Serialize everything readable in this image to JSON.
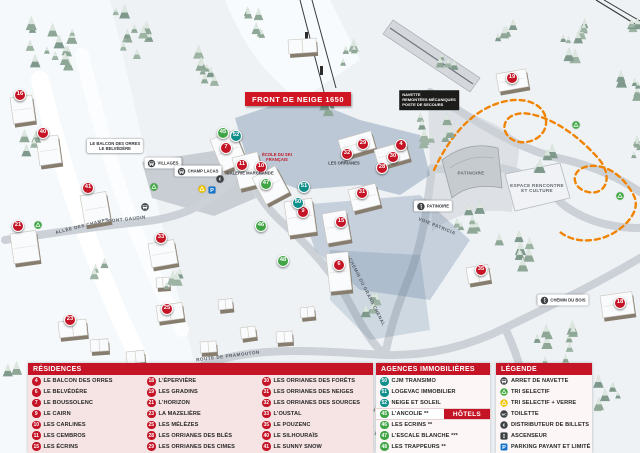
{
  "map": {
    "banner": "FRONT DE NEIGE 1650",
    "markers": [
      {
        "n": "16",
        "type": "residence",
        "x": 20,
        "y": 95
      },
      {
        "n": "40",
        "type": "residence",
        "x": 43,
        "y": 133
      },
      {
        "n": "41",
        "type": "residence",
        "x": 88,
        "y": 188
      },
      {
        "n": "21",
        "type": "residence",
        "x": 18,
        "y": 226
      },
      {
        "n": "23",
        "type": "residence",
        "x": 70,
        "y": 320
      },
      {
        "n": "25",
        "type": "residence",
        "x": 167,
        "y": 309
      },
      {
        "n": "33",
        "type": "residence",
        "x": 161,
        "y": 238
      },
      {
        "n": "7",
        "type": "residence",
        "x": 226,
        "y": 148
      },
      {
        "n": "11",
        "type": "residence",
        "x": 242,
        "y": 165
      },
      {
        "n": "10",
        "type": "residence",
        "x": 261,
        "y": 167
      },
      {
        "n": "9",
        "type": "residence",
        "x": 303,
        "y": 212
      },
      {
        "n": "15",
        "type": "residence",
        "x": 341,
        "y": 222
      },
      {
        "n": "6",
        "type": "residence",
        "x": 339,
        "y": 265
      },
      {
        "n": "29",
        "type": "residence",
        "x": 363,
        "y": 144
      },
      {
        "n": "32",
        "type": "residence",
        "x": 347,
        "y": 154
      },
      {
        "n": "4",
        "type": "residence",
        "x": 401,
        "y": 145
      },
      {
        "n": "30",
        "type": "residence",
        "x": 393,
        "y": 157
      },
      {
        "n": "28",
        "type": "residence",
        "x": 382,
        "y": 168
      },
      {
        "n": "31",
        "type": "residence",
        "x": 362,
        "y": 193
      },
      {
        "n": "19",
        "type": "residence",
        "x": 512,
        "y": 78
      },
      {
        "n": "35",
        "type": "residence",
        "x": 481,
        "y": 270
      },
      {
        "n": "18",
        "type": "residence",
        "x": 620,
        "y": 303
      },
      {
        "n": "52",
        "type": "agence",
        "x": 236,
        "y": 136
      },
      {
        "n": "51",
        "type": "agence",
        "x": 304,
        "y": 187
      },
      {
        "n": "50",
        "type": "agence",
        "x": 298,
        "y": 203
      },
      {
        "n": "45",
        "type": "hotel",
        "x": 223,
        "y": 133
      },
      {
        "n": "47",
        "type": "hotel",
        "x": 266,
        "y": 184
      },
      {
        "n": "46",
        "type": "hotel",
        "x": 261,
        "y": 226
      },
      {
        "n": "48",
        "type": "hotel",
        "x": 283,
        "y": 261
      }
    ],
    "labels": [
      {
        "cls": "darkbox",
        "lines": [
          "NAVETTE",
          "REMONTÉES MÉCANIQUES",
          "POSTE DE SECOURS"
        ],
        "x": 429,
        "y": 100
      },
      {
        "cls": "bldtext",
        "lines": [
          "PATINOIRE"
        ],
        "x": 471,
        "y": 173
      },
      {
        "cls": "bldtext",
        "lines": [
          "ESPACE RENCONTRE",
          "ET CULTURE"
        ],
        "x": 537,
        "y": 188
      },
      {
        "cls": "roadlbl",
        "lines": [
          "ALLÉE DES CHAMPS"
        ],
        "x": 82,
        "y": 226,
        "rot": -14
      },
      {
        "cls": "roadlbl",
        "lines": [
          "PONT GAUDIN"
        ],
        "x": 127,
        "y": 219,
        "rot": -6
      },
      {
        "cls": "roadlbl",
        "lines": [
          "ROUTE DE PRAMOUTON"
        ],
        "x": 228,
        "y": 356,
        "rot": -7
      },
      {
        "cls": "roadlbl",
        "lines": [
          "CHEMIN DU GRAND CHENAL"
        ],
        "x": 367,
        "y": 292,
        "rot": 63
      },
      {
        "cls": "roadlbl",
        "lines": [
          "VOIE PATRICIA"
        ],
        "x": 437,
        "y": 226,
        "rot": 22
      },
      {
        "cls": "tinylbl",
        "lines": [
          "GALERIE MARCHANDE"
        ],
        "x": 250,
        "y": 173
      },
      {
        "cls": "tinyred",
        "lines": [
          "ÉCOLE DU SKI",
          "FRANÇAIS"
        ],
        "x": 277,
        "y": 157
      },
      {
        "cls": "tinylbl",
        "lines": [
          "LES ORRIANES"
        ],
        "x": 344,
        "y": 163
      },
      {
        "cls": "pill",
        "lines": [
          "LE BALCON DES ORRES",
          "LE BELVÉDÈRE"
        ],
        "x": 115,
        "y": 146
      },
      {
        "cls": "pill-ic",
        "icon": "bus",
        "lines": [
          "VILLAGES"
        ],
        "x": 163,
        "y": 163
      },
      {
        "cls": "pill-ic",
        "icon": "bus",
        "lines": [
          "CHAMP LACAS"
        ],
        "x": 198,
        "y": 171
      },
      {
        "cls": "pill-ic",
        "icon": "skater",
        "lines": [
          "PATINOIRE"
        ],
        "x": 433,
        "y": 206
      },
      {
        "cls": "pill-ic",
        "icon": "walk",
        "lines": [
          "CHEMIN DU BOIS"
        ],
        "x": 563,
        "y": 300
      }
    ],
    "icons": [
      {
        "type": "bus",
        "x": 145,
        "y": 207
      },
      {
        "type": "recycle-green",
        "x": 38,
        "y": 225
      },
      {
        "type": "recycle-green",
        "x": 154,
        "y": 187
      },
      {
        "type": "recycle-green",
        "x": 576,
        "y": 125
      },
      {
        "type": "recycle-green",
        "x": 620,
        "y": 196
      },
      {
        "type": "recycle-yellow",
        "x": 202,
        "y": 189
      },
      {
        "type": "parking",
        "x": 212,
        "y": 190
      },
      {
        "type": "euro",
        "x": 220,
        "y": 179
      }
    ]
  },
  "legend": {
    "residences": {
      "title": "RÉSIDENCES",
      "items": [
        {
          "n": "4",
          "name": "LE BALCON DES ORRES"
        },
        {
          "n": "6",
          "name": "LE BELVÉDÈRE"
        },
        {
          "n": "7",
          "name": "LE BOUSSOLENC"
        },
        {
          "n": "9",
          "name": "LE CAIRN"
        },
        {
          "n": "10",
          "name": "LES CARLINES"
        },
        {
          "n": "11",
          "name": "LES CEMBROS"
        },
        {
          "n": "15",
          "name": "LES ÉCRINS"
        },
        {
          "n": "18",
          "name": "L'ÉPERVIÈRE"
        },
        {
          "n": "19",
          "name": "LES GRADINS"
        },
        {
          "n": "21",
          "name": "L'HORIZON"
        },
        {
          "n": "23",
          "name": "LA MAZELIÈRE"
        },
        {
          "n": "25",
          "name": "LES MÉLÈZES"
        },
        {
          "n": "28",
          "name": "LES ORRIANES DES BLÉS"
        },
        {
          "n": "29",
          "name": "LES ORRIANES DES CIMES"
        },
        {
          "n": "30",
          "name": "LES ORRIANES DES FORÊTS"
        },
        {
          "n": "31",
          "name": "LES ORRIANES DES NEIGES"
        },
        {
          "n": "32",
          "name": "LES ORRIANES DES SOURCES"
        },
        {
          "n": "33",
          "name": "L'OUSTAL"
        },
        {
          "n": "35",
          "name": "LE POUZENC"
        },
        {
          "n": "40",
          "name": "LE SILHOURAÏS"
        },
        {
          "n": "41",
          "name": "LE SUNNY SNOW"
        }
      ]
    },
    "agences": {
      "title": "AGENCES IMMOBILIÈRES",
      "items": [
        {
          "n": "50",
          "name": "CJM TRANSIMO"
        },
        {
          "n": "51",
          "name": "LOGEVAC IMMOBILIER"
        },
        {
          "n": "52",
          "name": "NEIGE ET SOLEIL"
        }
      ]
    },
    "hotels": {
      "title": "HÔTELS",
      "items": [
        {
          "n": "45",
          "name": "L'ANCOLIE **"
        },
        {
          "n": "46",
          "name": "LES ECRINS **"
        },
        {
          "n": "47",
          "name": "L'ESCALE BLANCHE ***"
        },
        {
          "n": "48",
          "name": "LES TRAPPEURS **"
        }
      ]
    },
    "legende": {
      "title": "LÉGENDE",
      "items": [
        {
          "icon": "navette",
          "name": "ARRET DE NAVETTE"
        },
        {
          "icon": "recycle-green",
          "name": "TRI SELECTIF"
        },
        {
          "icon": "recycle-yellow",
          "name": "TRI SELECTIF + VERRE"
        },
        {
          "icon": "toilette",
          "name": "TOILETTE"
        },
        {
          "icon": "euro",
          "name": "DISTRIBUTEUR DE BILLETS"
        },
        {
          "icon": "ascenseur",
          "name": "ASCENSEUR"
        },
        {
          "icon": "parking",
          "name": "PARKING PAYANT ET LIMITÉ"
        }
      ]
    }
  },
  "colors": {
    "residence": "#c41425",
    "agence": "#0e8f8a",
    "hotel": "#3fa544",
    "header_red": "#c41425",
    "panel_pink": "#f6e3e3",
    "path_orange": "#f08300",
    "parking_blue": "#1774cc"
  }
}
